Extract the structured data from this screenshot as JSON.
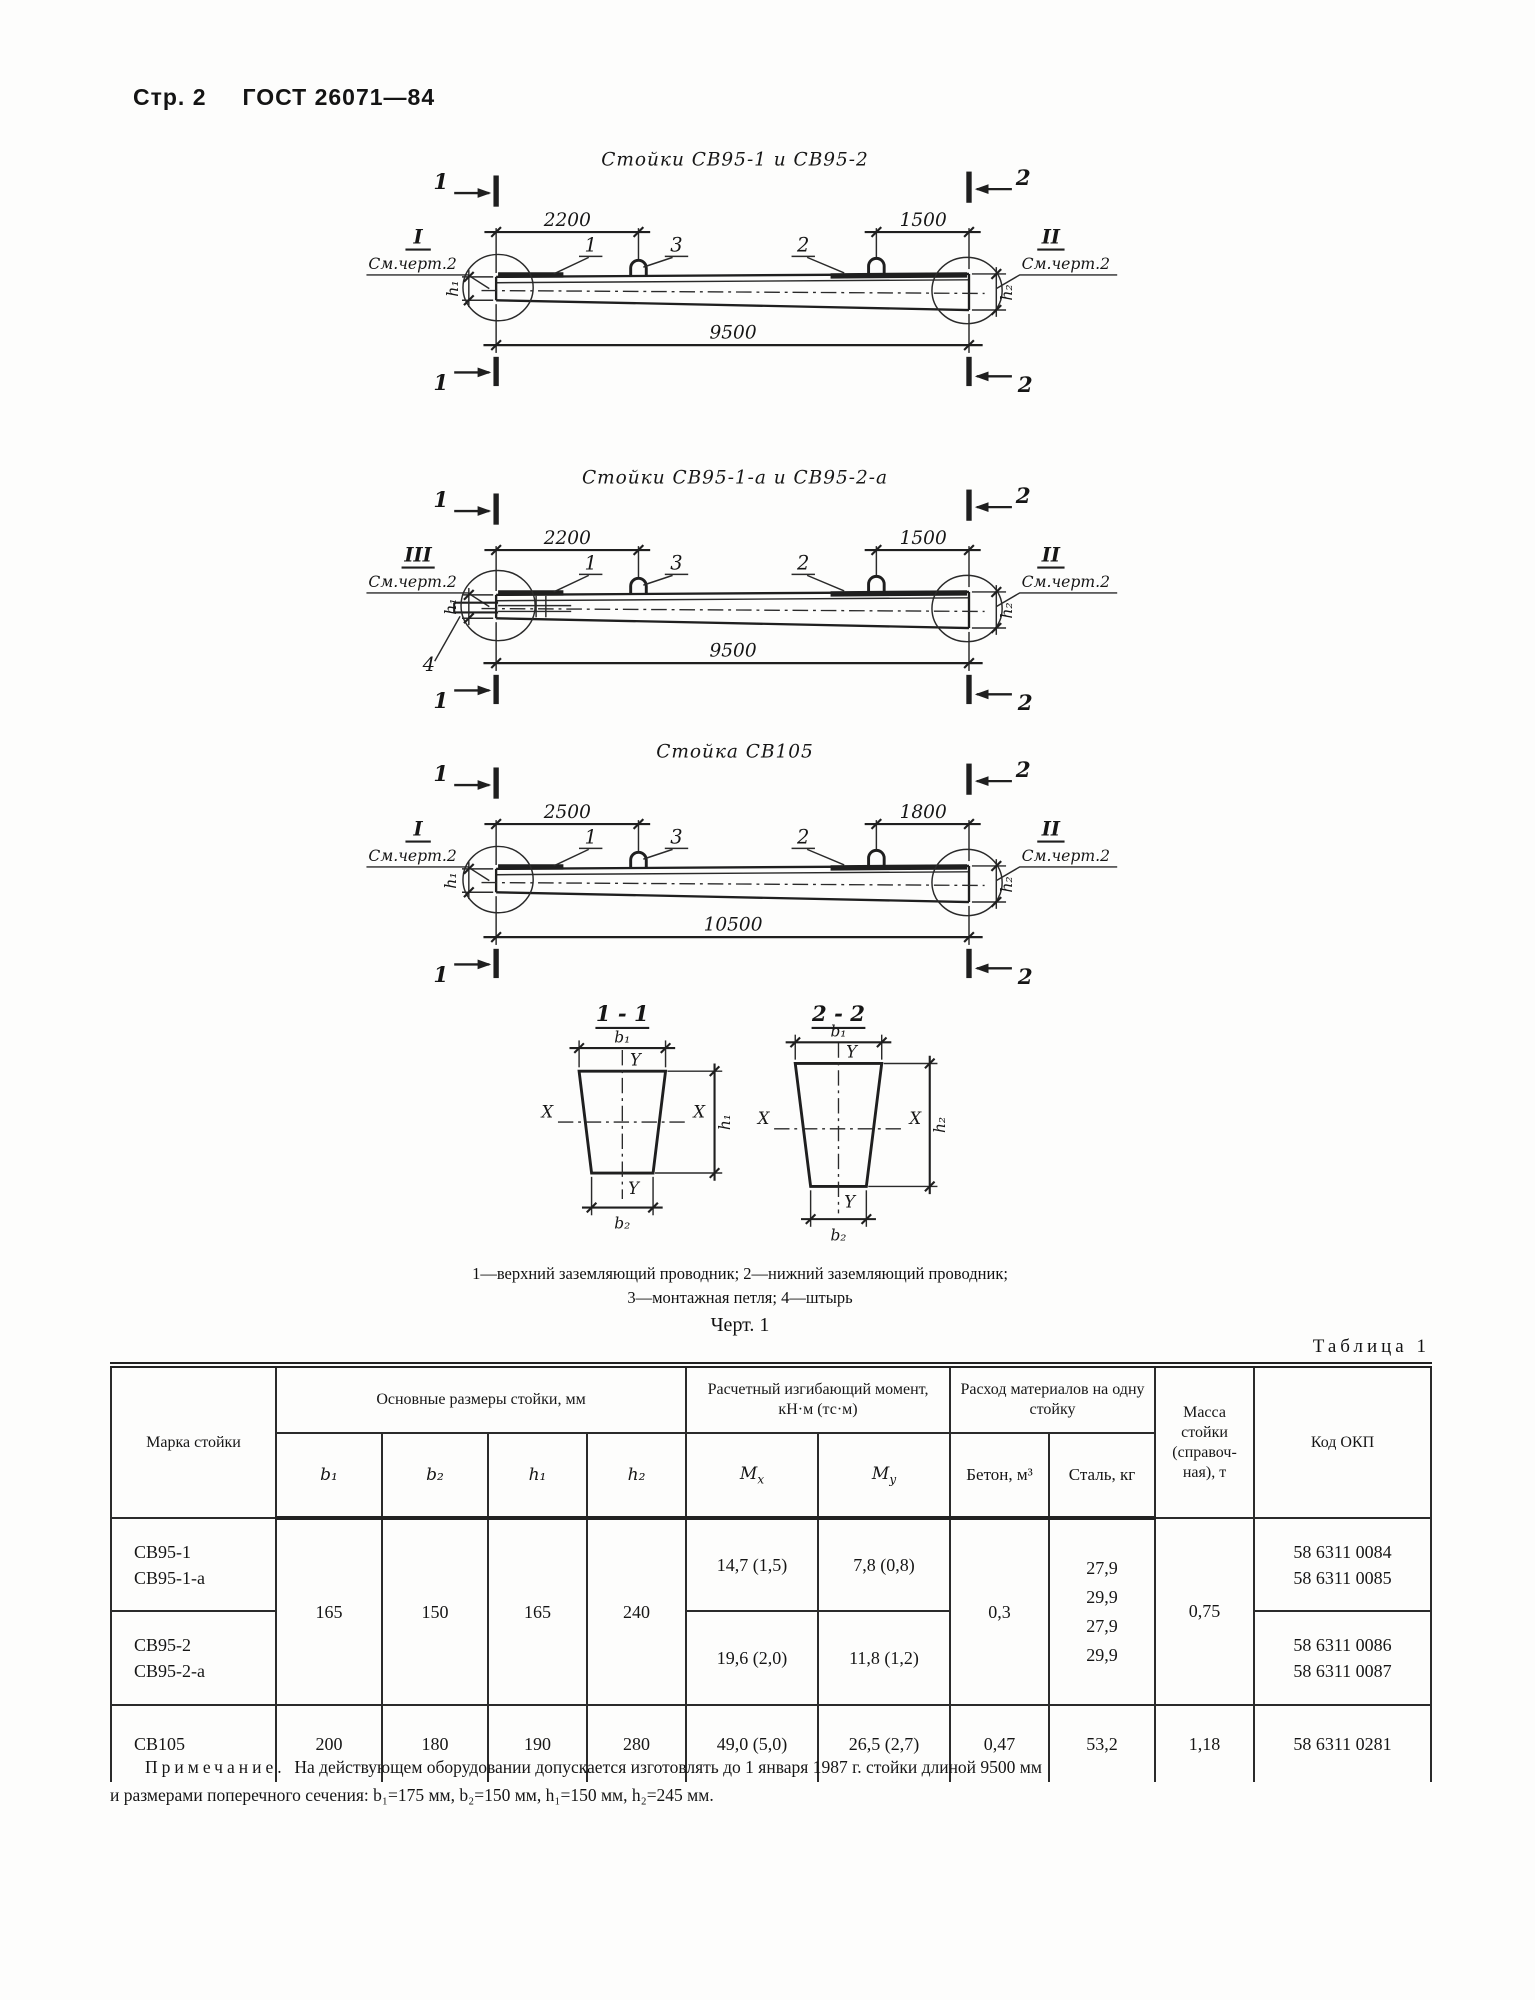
{
  "page": {
    "header_page": "Стр. 2",
    "header_doc": "ГОСТ 26071—84"
  },
  "figures": [
    {
      "title": "Стойки СВ95-1 и СВ95-2",
      "cut_left": "1",
      "cut_right": "2",
      "roman_left": "I",
      "roman_right": "II",
      "see_note": "См.черт.2",
      "dim_a": "2200",
      "dim_b": "1500",
      "dim_total": "9500",
      "callout_top": "1",
      "callout_loop": "3",
      "callout_bottom": "2",
      "h_left": "h₁",
      "h_right": "h₂"
    },
    {
      "title": "Стойки СВ95-1-а и СВ95-2-а",
      "cut_left": "1",
      "cut_right": "2",
      "roman_left": "III",
      "roman_right": "II",
      "see_note": "См.черт.2",
      "dim_a": "2200",
      "dim_b": "1500",
      "dim_total": "9500",
      "callout_top": "1",
      "callout_loop": "3",
      "callout_bottom": "2",
      "callout_pin": "4",
      "h_left": "h₁",
      "h_right": "h₂"
    },
    {
      "title": "Стойка СВ105",
      "cut_left": "1",
      "cut_right": "2",
      "roman_left": "I",
      "roman_right": "II",
      "see_note": "См.черт.2",
      "dim_a": "2500",
      "dim_b": "1800",
      "dim_total": "10500",
      "callout_top": "1",
      "callout_loop": "3",
      "callout_bottom": "2",
      "h_left": "h₁",
      "h_right": "h₂"
    }
  ],
  "sections": [
    {
      "title": "1 - 1",
      "b_top": "b₁",
      "b_bottom": "b₂",
      "h": "h₁",
      "x": "X",
      "y": "Y"
    },
    {
      "title": "2 - 2",
      "b_top": "b₁",
      "b_bottom": "b₂",
      "h": "h₂",
      "x": "X",
      "y": "Y"
    }
  ],
  "legend": {
    "line1": "1—верхний заземляющий проводник; 2—нижний заземляющий проводник;",
    "line2": "3—монтажная петля; 4—штырь",
    "caption": "Черт. 1"
  },
  "table": {
    "caption": "Таблица 1",
    "col_mark": "Марка стойки",
    "group_dims": "Основные размеры стойки, мм",
    "group_moment": "Расчетный изгибающий момент, кН·м (тс·м)",
    "group_materials": "Расход материалов на одну стойку",
    "col_mass": "Масса стойки (справоч- ная), т",
    "col_okp": "Код ОКП",
    "sub_b1": "b₁",
    "sub_b2": "b₂",
    "sub_h1": "h₁",
    "sub_h2": "h₂",
    "m_base": "M",
    "mx_sub": "x",
    "my_sub": "y",
    "sub_concrete": "Бетон, м³",
    "sub_steel": "Сталь, кг",
    "body": {
      "r1_mark1": "СВ95-1",
      "r1_mark2": "СВ95-1-а",
      "r2_mark1": "СВ95-2",
      "r2_mark2": "СВ95-2-а",
      "r3_mark": "СВ105",
      "dims12": [
        "165",
        "150",
        "165",
        "240"
      ],
      "dims3": [
        "200",
        "180",
        "190",
        "280"
      ],
      "mx": [
        "14,7 (1,5)",
        "19,6 (2,0)",
        "49,0 (5,0)"
      ],
      "my": [
        "7,8 (0,8)",
        "11,8 (1,2)",
        "26,5 (2,7)"
      ],
      "concrete12": "0,3",
      "concrete3": "0,47",
      "steel12": [
        "27,9",
        "29,9",
        "27,9",
        "29,9"
      ],
      "steel3": "53,2",
      "mass12": "0,75",
      "mass3": "1,18",
      "okp1a": "58 6311 0084",
      "okp1b": "58 6311 0085",
      "okp2a": "58 6311 0086",
      "okp2b": "58 6311 0087",
      "okp3": "58 6311 0281"
    }
  },
  "note": {
    "label": "Примечание.",
    "line1": "На действующем оборудовании допускается изготовлять до 1 января 1987 г. стойки длиной 9500 мм",
    "line2": "и размерами поперечного сечения: b₁=175 мм, b₂=150 мм, h₁=150 мм, h₂=245 мм."
  }
}
